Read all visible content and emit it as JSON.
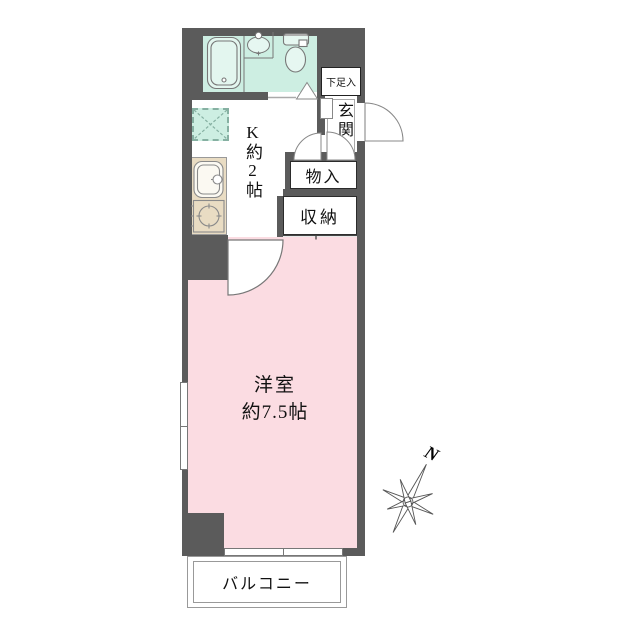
{
  "floorplan": {
    "labels": {
      "shoe_storage": "下足入",
      "entrance": "玄関",
      "storage": "物入",
      "closet": "収納",
      "kitchen": "K約2帖",
      "main_room_name": "洋室",
      "main_room_size": "約7.5帖",
      "balcony": "バルコニー",
      "compass_north": "N"
    },
    "colors": {
      "wall": "#5b5b5b",
      "wet_area": "#cdeee2",
      "main_room": "#fbdce2",
      "kitchen_counter": "#e9dcc3",
      "outline_gray": "#777777"
    }
  }
}
